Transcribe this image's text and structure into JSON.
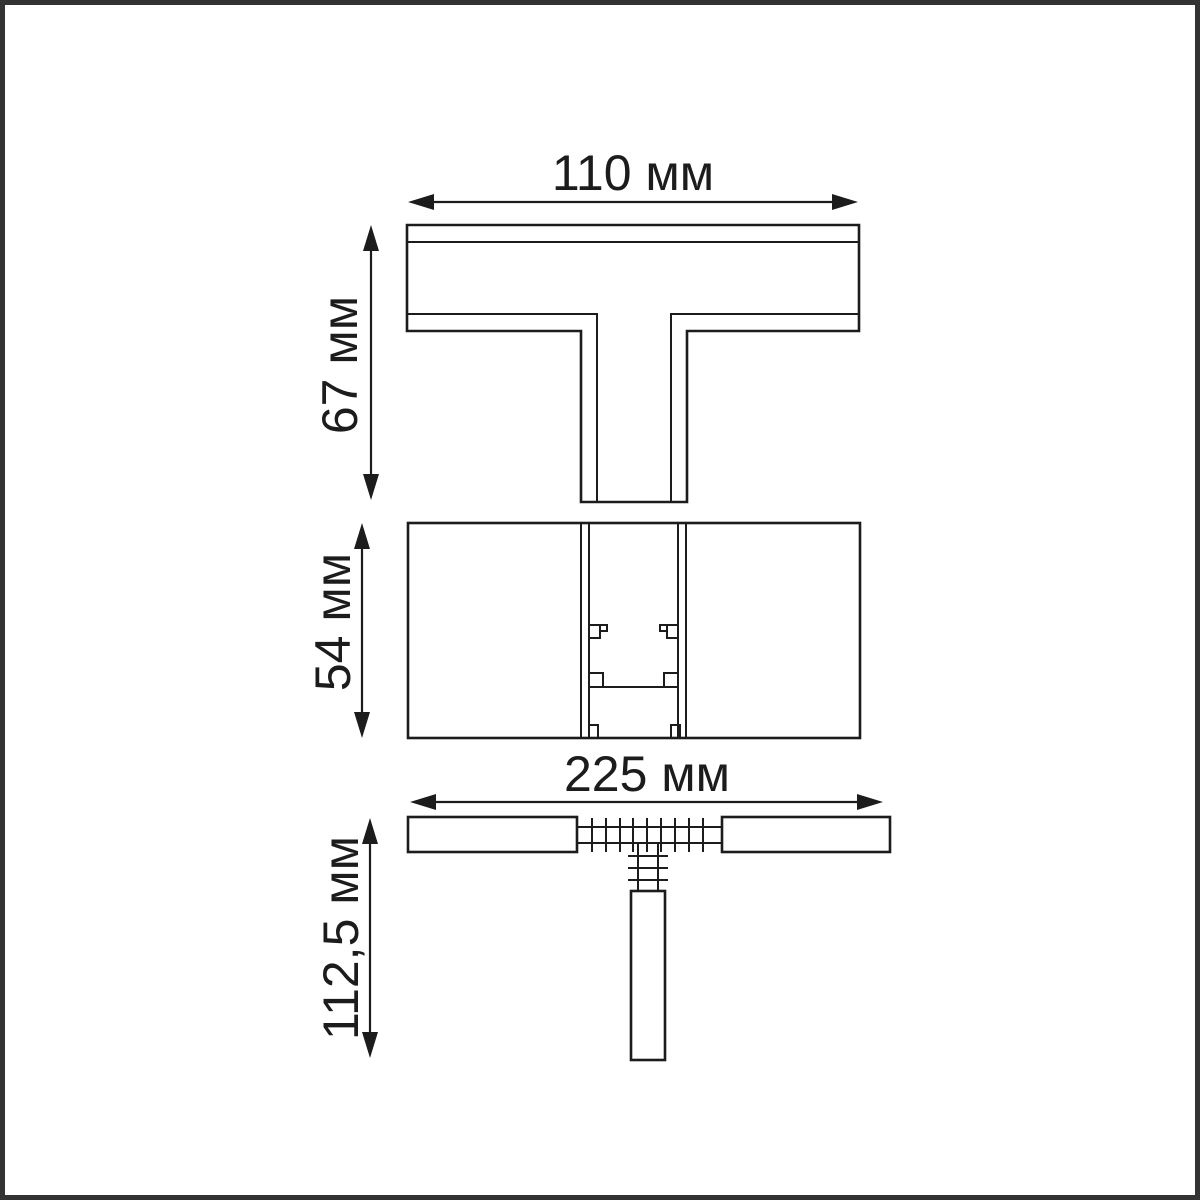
{
  "canvas": {
    "width": 1200,
    "height": 1200
  },
  "colors": {
    "background": "#ffffff",
    "line": "#1c1c1c",
    "text": "#1c1c1c",
    "frame": "#333333"
  },
  "drawing": {
    "type": "technical-dimension-drawing",
    "views": {
      "top": {
        "id": "top-view",
        "description": "T-profile plan view"
      },
      "middle": {
        "id": "middle-section-view",
        "description": "section view with connector tabs"
      },
      "bottom": {
        "id": "bottom-side-view",
        "description": "side view with toothed connectors and stem"
      }
    },
    "dimensions": {
      "top_width": {
        "label": "110 мм",
        "value": "110",
        "unit": "мм"
      },
      "top_height": {
        "label": "67 мм",
        "value": "67",
        "unit": "мм"
      },
      "mid_height": {
        "label": "54 мм",
        "value": "54",
        "unit": "мм"
      },
      "bot_width": {
        "label": "225 мм",
        "value": "225",
        "unit": "мм"
      },
      "bot_height": {
        "label": "112,5 мм",
        "value": "112,5",
        "unit": "мм"
      }
    }
  }
}
